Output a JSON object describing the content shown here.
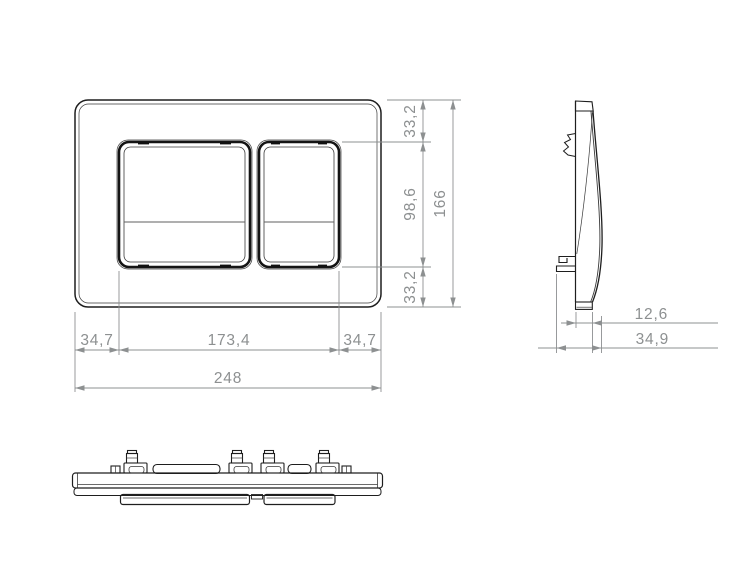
{
  "drawing": {
    "kind": "technical-dimension-drawing",
    "subject": "dual-flush wall plate with two buttons, front / side / bottom views",
    "units_style": "decimal-comma millimetres"
  },
  "dims": {
    "front_vertical": {
      "top": "33,2",
      "middle": "98,6",
      "bottom": "33,2",
      "total": "166"
    },
    "front_horizontal": {
      "left": "34,7",
      "center": "173,4",
      "right": "34,7",
      "total": "248"
    },
    "side": {
      "thickness": "12,6",
      "depth": "34,9"
    }
  },
  "colors": {
    "background": "#ffffff",
    "geometry_line": "#1e1e1e",
    "dimension_line": "#8d9091",
    "dimension_text": "#8d9091"
  }
}
